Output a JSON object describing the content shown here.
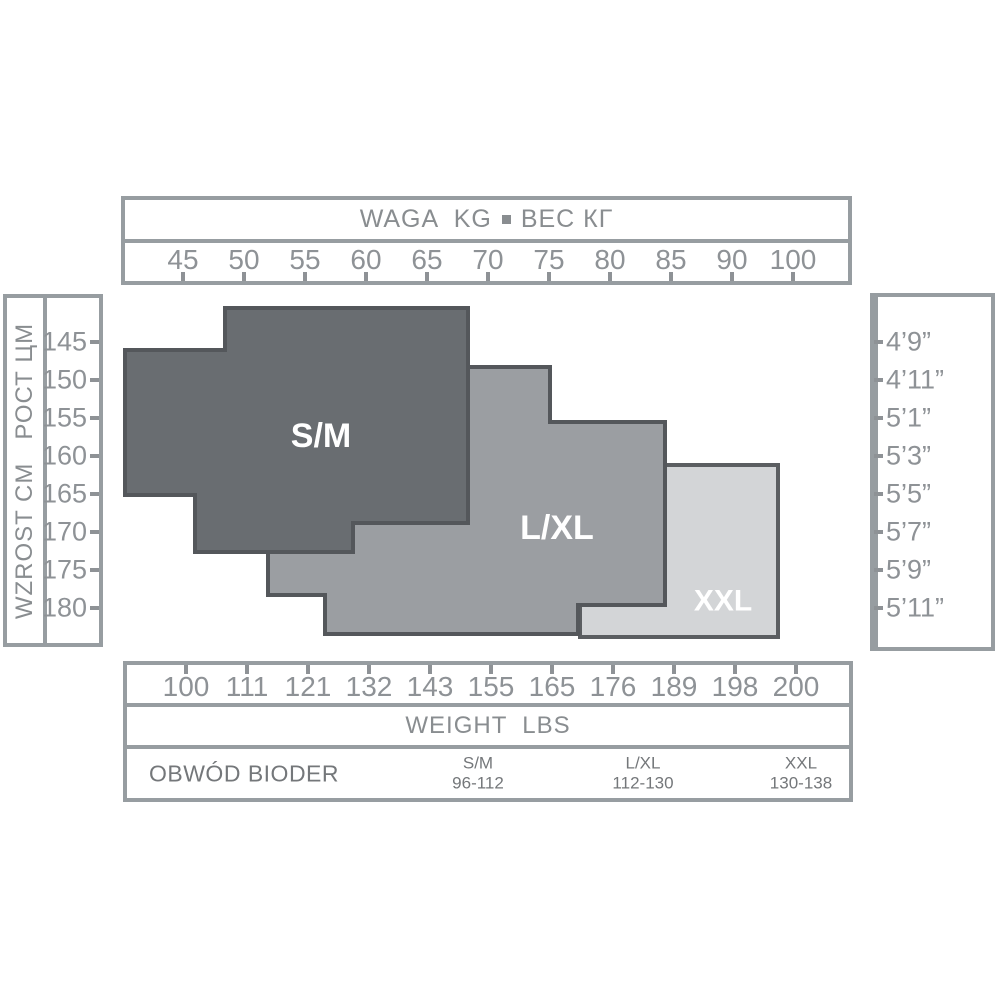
{
  "colors": {
    "background": "#ffffff",
    "box_border": "#979da1",
    "axis_text": "#8e9296",
    "axis_title_text": "#898d90",
    "table_text": "#74777a",
    "label_text": "#ffffff",
    "region_sm_fill": "#696d71",
    "region_sm_stroke": "#54575b",
    "region_lxl_fill": "#9b9ea2",
    "region_lxl_stroke": "#54575b",
    "region_xxl_fill": "#d3d5d7",
    "region_xxl_stroke": "#5b5e61"
  },
  "top_axis": {
    "title_left": "WAGA  KG",
    "title_right": "ВЕС КГ",
    "ticks": [
      "45",
      "50",
      "55",
      "60",
      "65",
      "70",
      "75",
      "80",
      "85",
      "90",
      "100"
    ]
  },
  "left_axis": {
    "label": "WZROST CM   РОСТ ЦМ",
    "ticks": [
      "145",
      "150",
      "155",
      "160",
      "165",
      "170",
      "175",
      "180"
    ]
  },
  "right_axis": {
    "label": "HEIGHT  FEET  INCHES",
    "ticks": [
      "4’9”",
      "4’11”",
      "5’1”",
      "5’3”",
      "5’5”",
      "5’7”",
      "5’9”",
      "5’11”"
    ]
  },
  "bottom_axis": {
    "ticks": [
      "100",
      "111",
      "121",
      "132",
      "143",
      "155",
      "165",
      "176",
      "189",
      "198",
      "200"
    ],
    "title": "WEIGHT  LBS"
  },
  "hips_row": {
    "label": "OBWÓD BIODER",
    "entries": [
      {
        "size": "S/M",
        "range": "96-112"
      },
      {
        "size": "L/XL",
        "range": "112-130"
      },
      {
        "size": "XXL",
        "range": "130-138"
      }
    ]
  },
  "chart_data": {
    "type": "area",
    "title": "Tights size chart — size regions by body weight and height",
    "axes": {
      "top": {
        "label": "WAGA KG ВЕС КГ",
        "unit": "kg",
        "ticks": [
          45,
          50,
          55,
          60,
          65,
          70,
          75,
          80,
          85,
          90,
          100
        ]
      },
      "bottom": {
        "label": "WEIGHT LBS",
        "unit": "lbs",
        "ticks": [
          100,
          111,
          121,
          132,
          143,
          155,
          165,
          176,
          189,
          198,
          200
        ]
      },
      "left": {
        "label": "WZROST CM РОСТ ЦМ",
        "unit": "cm",
        "ticks": [
          145,
          150,
          155,
          160,
          165,
          170,
          175,
          180
        ]
      },
      "right": {
        "label": "HEIGHT FEET INCHES",
        "ticks": [
          "4’9”",
          "4’11”",
          "5’1”",
          "5’3”",
          "5’5”",
          "5’7”",
          "5’9”",
          "5’11”"
        ]
      }
    },
    "legend_position": "none",
    "grid": false,
    "z_order_bottom_to_top": [
      "XXL",
      "L/XL",
      "S/M"
    ],
    "regions": [
      {
        "label": "S/M",
        "hips_range": "96-112",
        "approx_weight_kg": [
          40,
          68
        ],
        "approx_height_cm": [
          140,
          173
        ],
        "fill": "#696d71",
        "stroke": "#54575b",
        "points_px": [
          [
            225,
            308
          ],
          [
            468,
            308
          ],
          [
            468,
            523
          ],
          [
            353,
            523
          ],
          [
            353,
            552
          ],
          [
            195,
            552
          ],
          [
            195,
            495
          ],
          [
            125,
            495
          ],
          [
            125,
            350
          ],
          [
            225,
            350
          ]
        ],
        "label_px": [
          321,
          436
        ],
        "label_font_px": 34
      },
      {
        "label": "L/XL",
        "hips_range": "112-130",
        "approx_weight_kg": [
          52,
          84
        ],
        "approx_height_cm": [
          148,
          183
        ],
        "fill": "#9b9ea2",
        "stroke": "#54575b",
        "points_px": [
          [
            268,
            367
          ],
          [
            550,
            367
          ],
          [
            550,
            422
          ],
          [
            665,
            422
          ],
          [
            665,
            605
          ],
          [
            578,
            605
          ],
          [
            578,
            634
          ],
          [
            325,
            634
          ],
          [
            325,
            595
          ],
          [
            268,
            595
          ]
        ],
        "label_px": [
          557,
          528
        ],
        "label_font_px": 34
      },
      {
        "label": "XXL",
        "hips_range": "130-138",
        "approx_weight_kg": [
          77,
          94
        ],
        "approx_height_cm": [
          161,
          184
        ],
        "fill": "#d3d5d7",
        "stroke": "#5b5e61",
        "points_px": [
          [
            665,
            465
          ],
          [
            778,
            465
          ],
          [
            778,
            637
          ],
          [
            580,
            637
          ],
          [
            580,
            605
          ],
          [
            665,
            605
          ]
        ],
        "label_px": [
          723,
          601
        ],
        "label_font_px": 30
      }
    ]
  }
}
